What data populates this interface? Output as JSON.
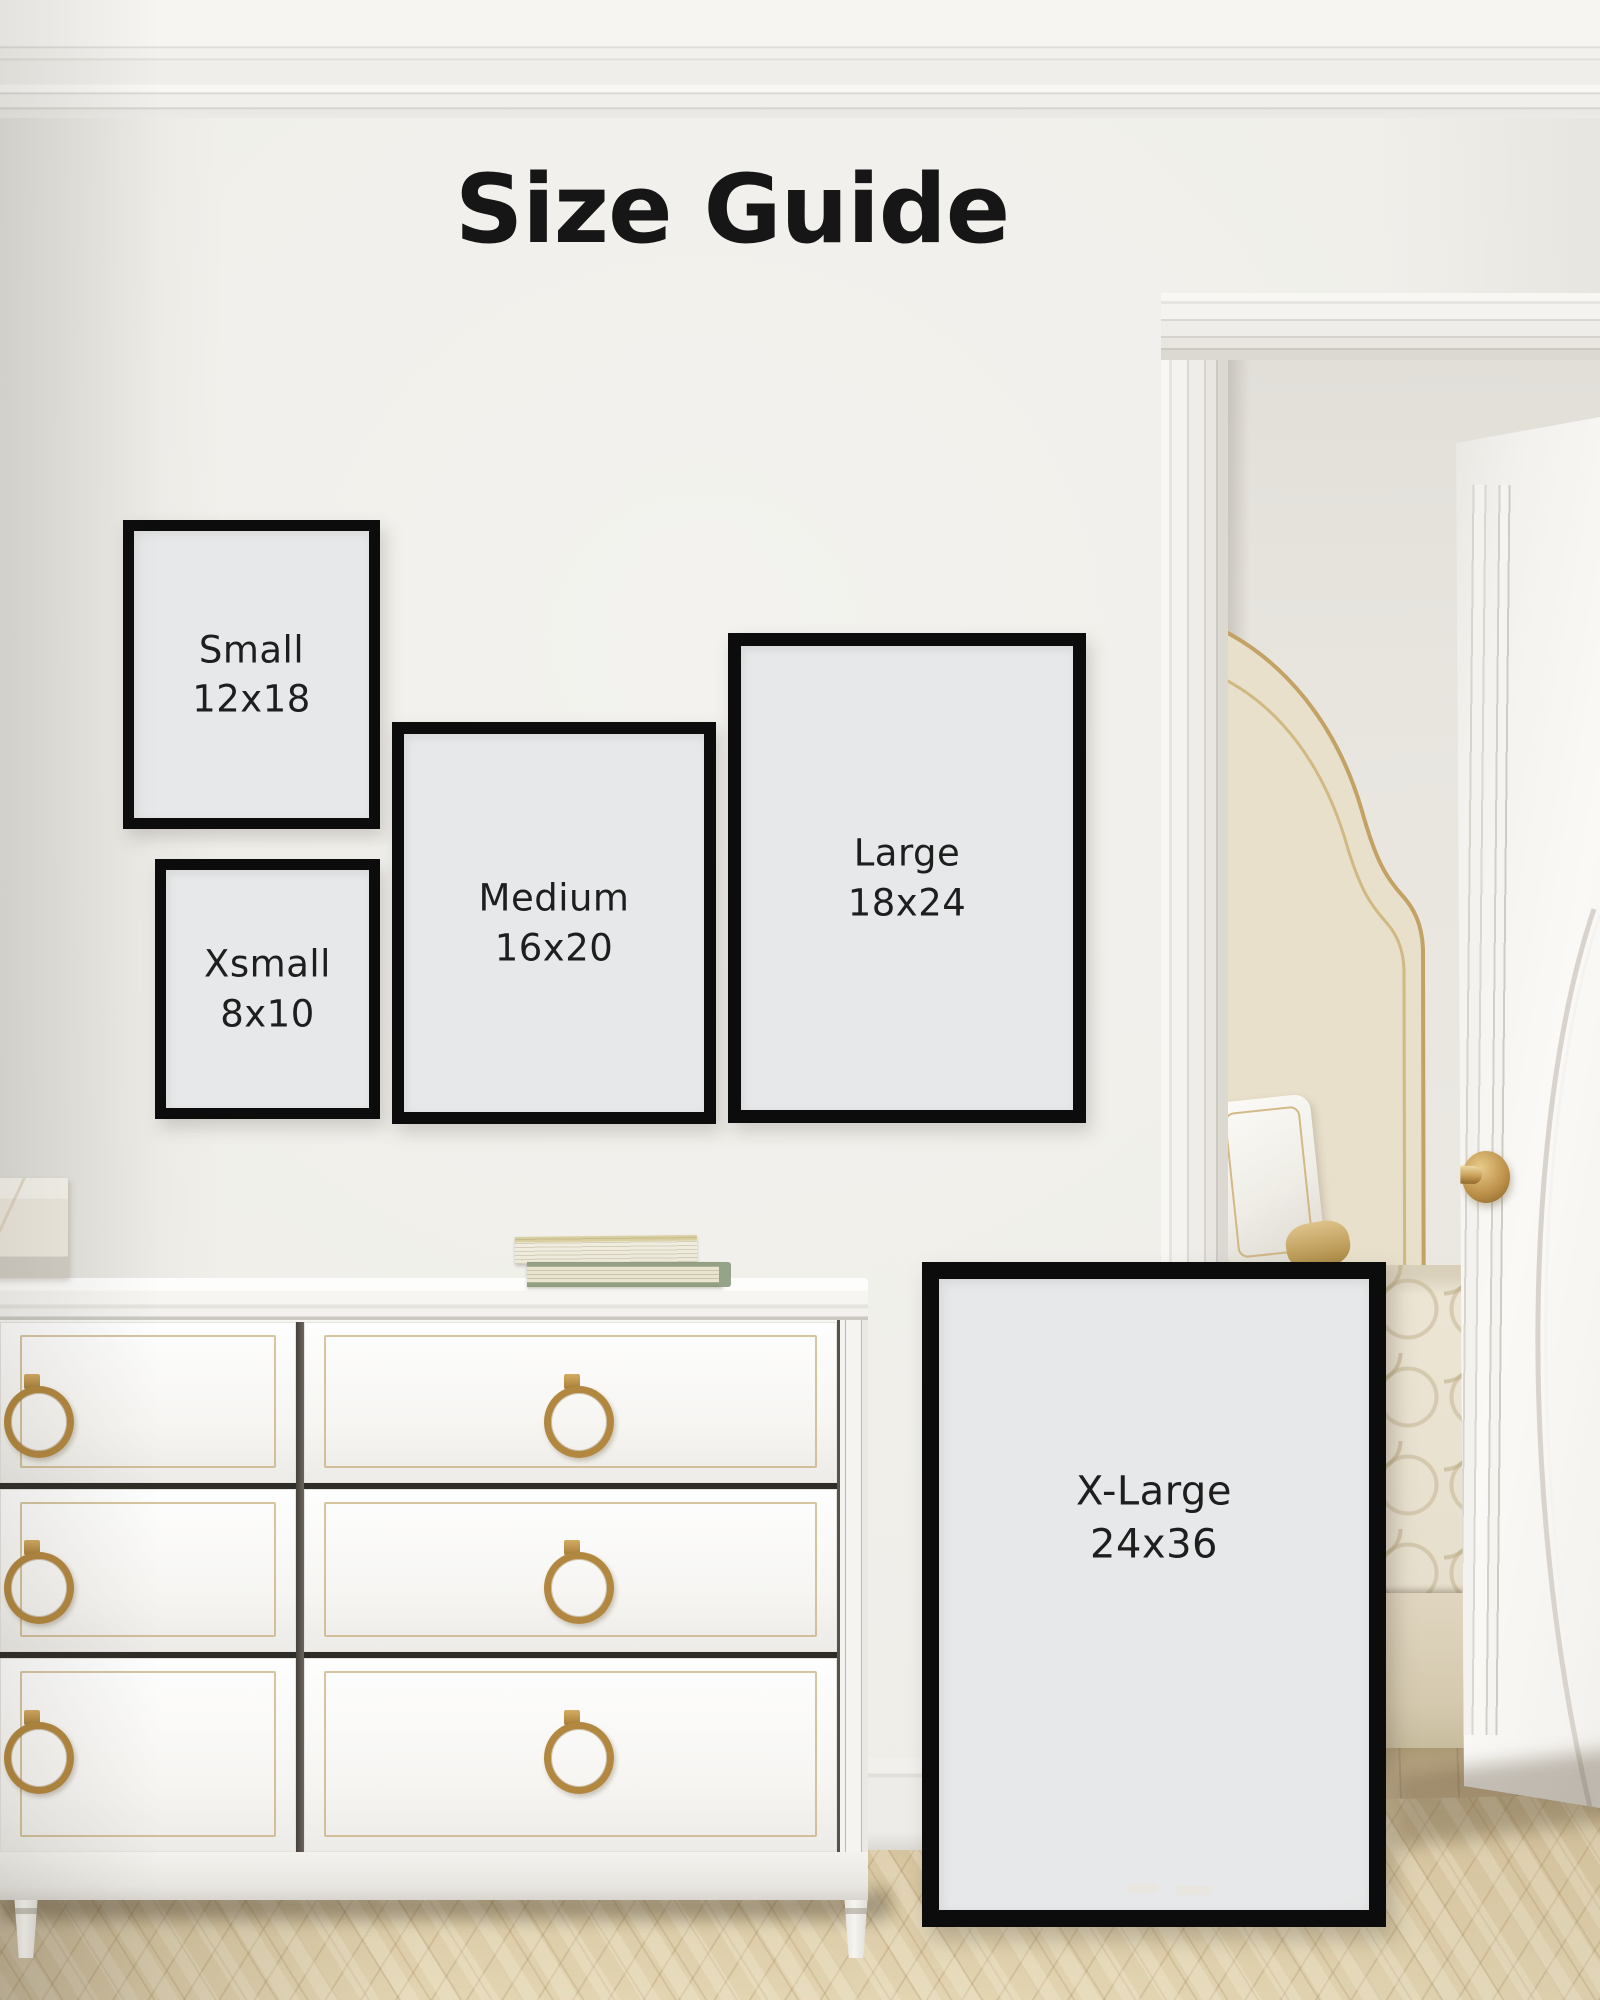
{
  "page": {
    "title": "Size Guide"
  },
  "frames": [
    {
      "name": "Small",
      "size": "12x18"
    },
    {
      "name": "Xsmall",
      "size": "8x10"
    },
    {
      "name": "Medium",
      "size": "16x20"
    },
    {
      "name": "Large",
      "size": "18x24"
    },
    {
      "name": "X-Large",
      "size": "24x36"
    }
  ],
  "colors": {
    "frame_border": "#0c0c0c",
    "frame_matte": "#e7e8e9",
    "label_text": "#1e1e1e",
    "wall": "#efeee9",
    "brass": "#b2873f",
    "floor_wood": "#d8c7a2"
  }
}
